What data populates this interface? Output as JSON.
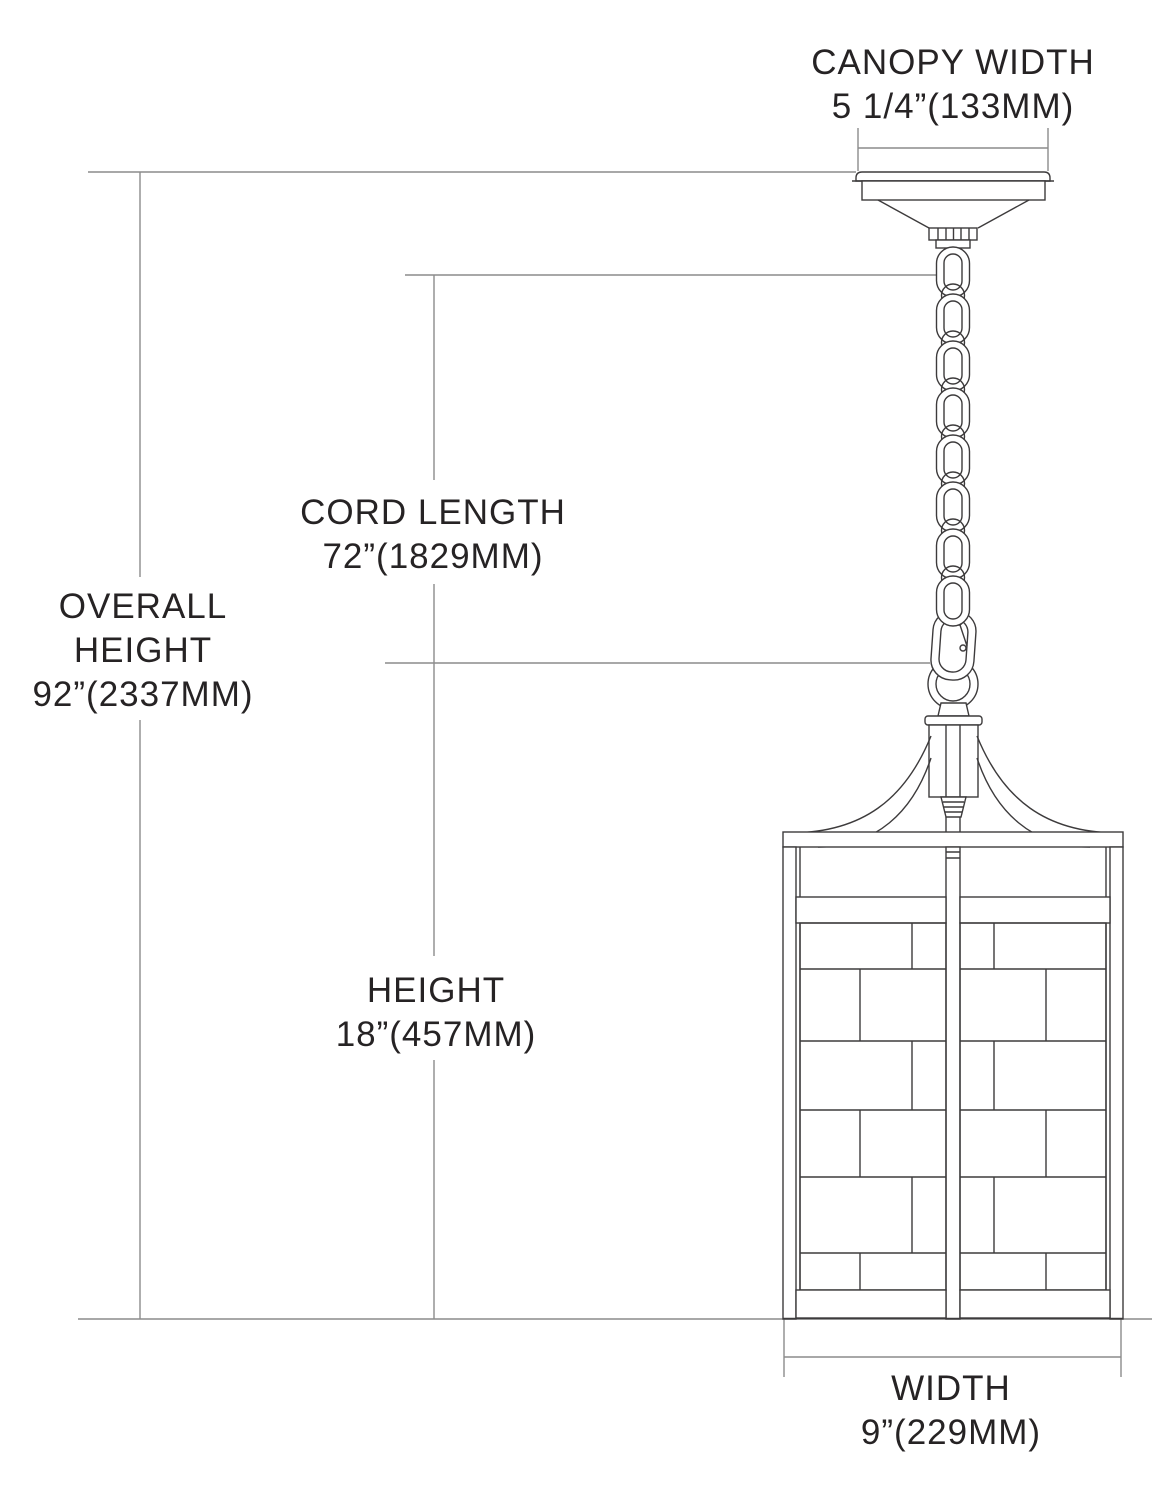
{
  "dimensions": {
    "canopy_width": {
      "lines": [
        "CANOPY WIDTH",
        "5 1/4”(133MM)"
      ]
    },
    "cord_length": {
      "lines": [
        "CORD LENGTH",
        "72”(1829MM)"
      ]
    },
    "overall_height": {
      "lines": [
        "OVERALL",
        "HEIGHT",
        "92”(2337MM)"
      ]
    },
    "height": {
      "lines": [
        "HEIGHT",
        "18”(457MM)"
      ]
    },
    "width": {
      "lines": [
        "WIDTH",
        "9”(229MM)"
      ]
    }
  },
  "colors": {
    "background": "#ffffff",
    "fixture_line": "#3d3b3c",
    "dimension_line": "#8c8c8c",
    "text": "#262324"
  }
}
